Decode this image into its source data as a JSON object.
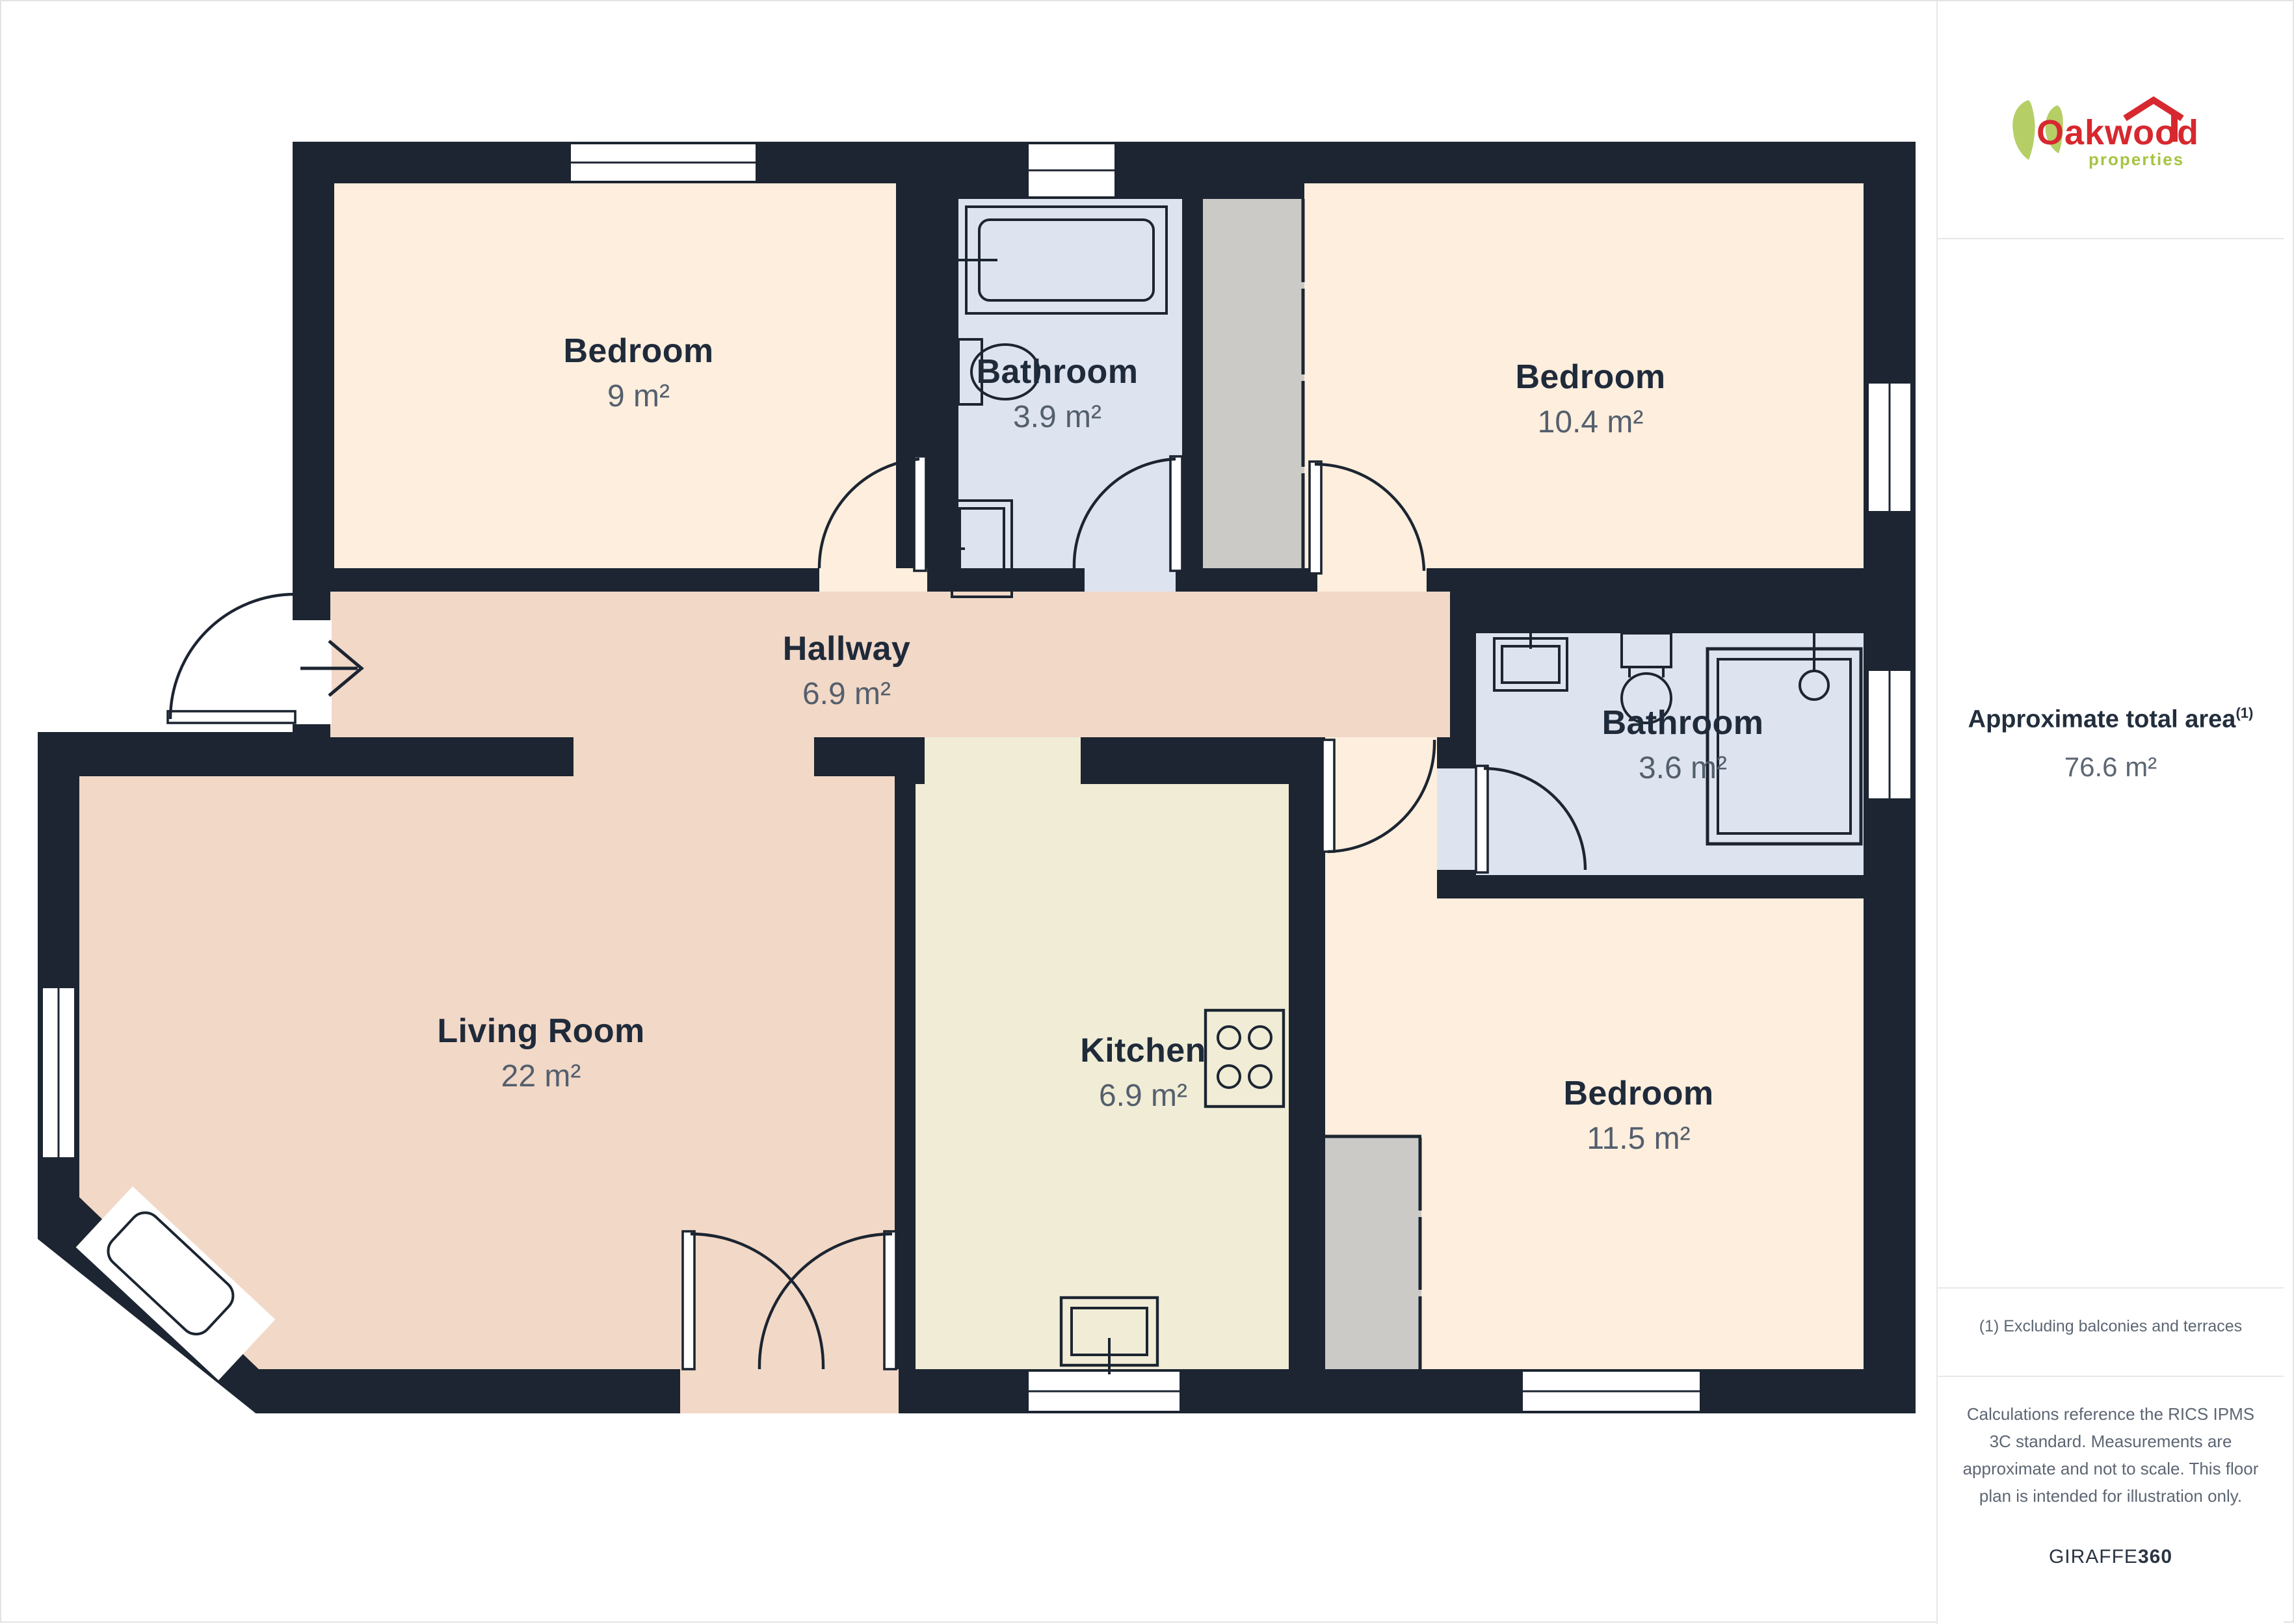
{
  "theme": {
    "wall": "#1c2531",
    "bedroom": "#fdeedd",
    "bathroom": "#dee4ef",
    "hall": "#f2d8c7",
    "kitchen": "#f0ecd6",
    "shaft": "#cbcac7",
    "label": "#1f2a3a",
    "area": "#545f6d",
    "divider": "#e5e7e9",
    "logo-red": "#d7282f",
    "logo-green": "#a6c443"
  },
  "floorplan": {
    "rooms": [
      {
        "id": "bedroom-9",
        "name": "Bedroom",
        "area": "9 m²"
      },
      {
        "id": "bathroom-3-9",
        "name": "Bathroom",
        "area": "3.9 m²"
      },
      {
        "id": "bedroom-10-4",
        "name": "Bedroom",
        "area": "10.4 m²"
      },
      {
        "id": "hallway",
        "name": "Hallway",
        "area": "6.9 m²"
      },
      {
        "id": "living-room",
        "name": "Living Room",
        "area": "22 m²"
      },
      {
        "id": "kitchen",
        "name": "Kitchen",
        "area": "6.9 m²"
      },
      {
        "id": "bathroom-3-6",
        "name": "Bathroom",
        "area": "3.6 m²"
      },
      {
        "id": "bedroom-11-5",
        "name": "Bedroom",
        "area": "11.5 m²"
      }
    ]
  },
  "sidebar": {
    "logo_brand": "Oakwood",
    "logo_sub": "properties",
    "total_area_label": "Approximate total area",
    "total_area_marker": "(1)",
    "total_area_value": "76.6 m²",
    "footnote": "(1) Excluding balconies and terraces",
    "disclaimer": "Calculations reference the RICS IPMS 3C standard. Measurements are approximate and not to scale. This floor plan is intended for illustration only.",
    "credit_regular": "GIRAFFE",
    "credit_bold": "360"
  }
}
